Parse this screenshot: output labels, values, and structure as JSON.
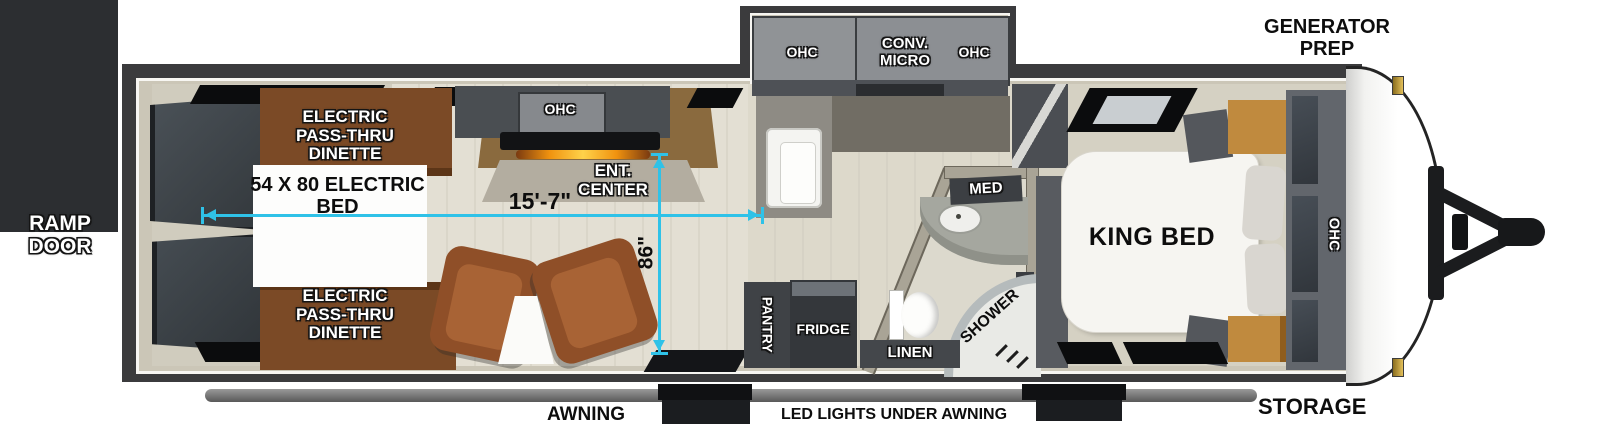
{
  "labels": {
    "ramp_door": "RAMP DOOR",
    "dinette_top": "ELECTRIC PASS-THRU DINETTE",
    "dinette_bottom": "ELECTRIC PASS-THRU DINETTE",
    "electric_bed": "54 X 80 ELECTRIC BED",
    "ohc_living": "OHC",
    "ent_center": "ENT. CENTER",
    "ohc_kitchen_left": "OHC",
    "conv_micro": "CONV. MICRO",
    "ohc_kitchen_right": "OHC",
    "pantry": "PANTRY",
    "fridge": "FRIDGE",
    "med": "MED",
    "shower": "SHOWER",
    "linen": "LINEN",
    "king_bed": "KING BED",
    "ohc_bedroom": "OHC",
    "generator_prep": "GENERATOR PREP",
    "storage": "STORAGE",
    "awning": "AWNING",
    "led_lights": "LED LIGHTS UNDER AWNING",
    "dim_length": "15'-7\"",
    "dim_width": "86\""
  },
  "colors": {
    "dimension_accent": "#2fc2e8",
    "outer_wall": "#3b3b3d",
    "floor_beige": "#d6d2c4",
    "dinette_wood": "#7b4a26",
    "chair_brown": "#9c5a30",
    "cabinet_gray": "#8c8f93",
    "marker_light_gold": "#c9a23c"
  }
}
